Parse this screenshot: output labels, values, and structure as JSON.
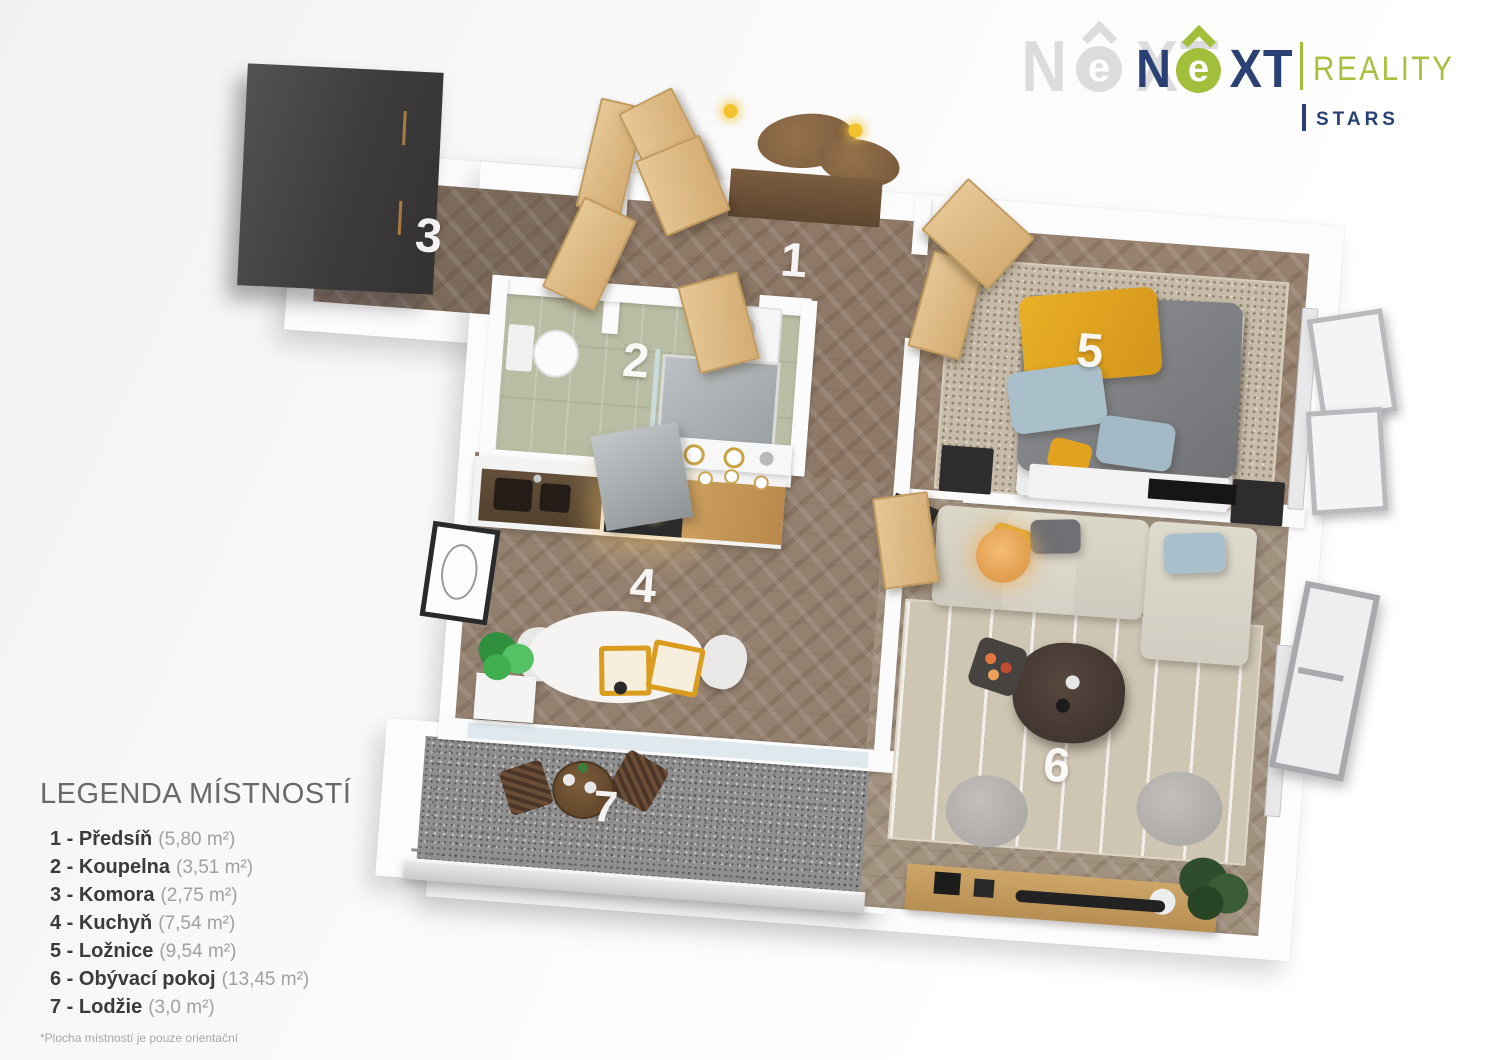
{
  "brand": {
    "name_n": "N",
    "name_e": "e",
    "name_xt": "XT",
    "reality": "REALITY",
    "stars": "STARS",
    "colors": {
      "navy": "#2a4173",
      "green": "#a2bf3b"
    }
  },
  "legend": {
    "title": "LEGENDA MÍSTNOSTÍ",
    "footnote": "*Plocha místností je pouze orientační"
  },
  "plan": {
    "rooms": [
      {
        "number": "1",
        "name": "Předsíň",
        "label": "1 - Předsíň",
        "area": "(5,80 m²)"
      },
      {
        "number": "2",
        "name": "Koupelna",
        "label": "2 - Koupelna",
        "area": "(3,51 m²)"
      },
      {
        "number": "3",
        "name": "Komora",
        "label": "3 - Komora",
        "area": "(2,75 m²)"
      },
      {
        "number": "4",
        "name": "Kuchyň",
        "label": "4 - Kuchyň",
        "area": "(7,54 m²)"
      },
      {
        "number": "5",
        "name": "Ložnice",
        "label": "5 - Ložnice",
        "area": "(9,54 m²)"
      },
      {
        "number": "6",
        "name": "Obývací pokoj",
        "label": "6 - Obývací pokoj",
        "area": "(13,45 m²)"
      },
      {
        "number": "7",
        "name": "Lodžie",
        "label": "7 - Lodžie",
        "area": "(3,0 m²)"
      }
    ]
  }
}
